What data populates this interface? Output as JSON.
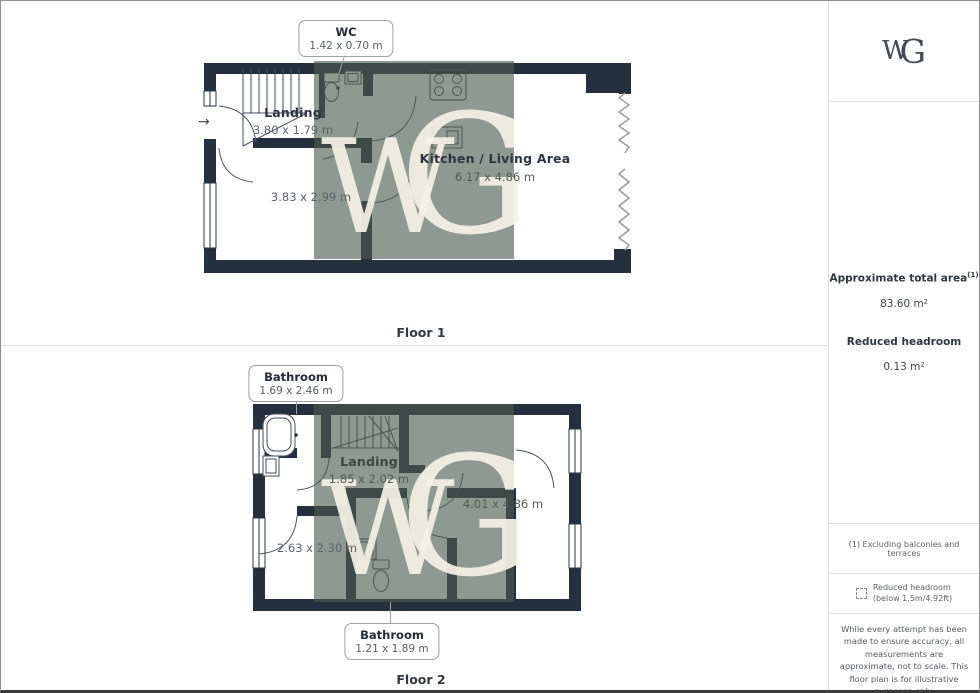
{
  "colors": {
    "wall": "#25303e",
    "watermark_overlay_rgba": "rgba(76,91,78,0.62)",
    "watermark_letters": "#f3f0e5",
    "callout_border": "#9aa0a6"
  },
  "icons": {
    "entry_arrow": "→"
  },
  "watermark": {
    "w": "W",
    "g": "G"
  },
  "floor1": {
    "label": "Floor 1",
    "callouts": {
      "wc": {
        "title": "WC",
        "dims": "1.42 x 0.70 m"
      }
    },
    "rooms": {
      "landing": {
        "title": "Landing",
        "dims": "3.80 x 1.79 m"
      },
      "kitchen_living": {
        "title": "Kitchen / Living Area",
        "dims": "6.17 x 4.86 m"
      },
      "room": {
        "dims": "3.83 x 2.99 m"
      }
    }
  },
  "floor2": {
    "label": "Floor 2",
    "callouts": {
      "bathroom_top": {
        "title": "Bathroom",
        "dims": "1.69 x 2.46 m"
      },
      "bathroom_bottom": {
        "title": "Bathroom",
        "dims": "1.21 x 1.89 m"
      }
    },
    "rooms": {
      "landing": {
        "title": "Landing",
        "dims": "1.85 x 2.02 m"
      },
      "bedroom": {
        "dims": "4.01 x 4.86 m"
      },
      "room": {
        "dims": "2.63 x 2.30 m"
      }
    }
  },
  "sidebar": {
    "logo_w": "W",
    "logo_g": "G",
    "total_area_label": "Approximate total area",
    "total_area_sup": "(1)",
    "total_area_value": "83.60 m²",
    "reduced_headroom_label": "Reduced headroom",
    "reduced_headroom_value": "0.13 m²",
    "footnote_1": "(1) Excluding balconies and terraces",
    "legend_line1": "Reduced headroom",
    "legend_line2": "(below 1.5m/4.92ft)",
    "disclaimer": "While every attempt has been made to ensure accuracy, all measurements are approximate, not to scale. This floor plan is for illustrative purposes only.",
    "brand_name": "GIRAFFE",
    "brand_suffix": "360"
  }
}
